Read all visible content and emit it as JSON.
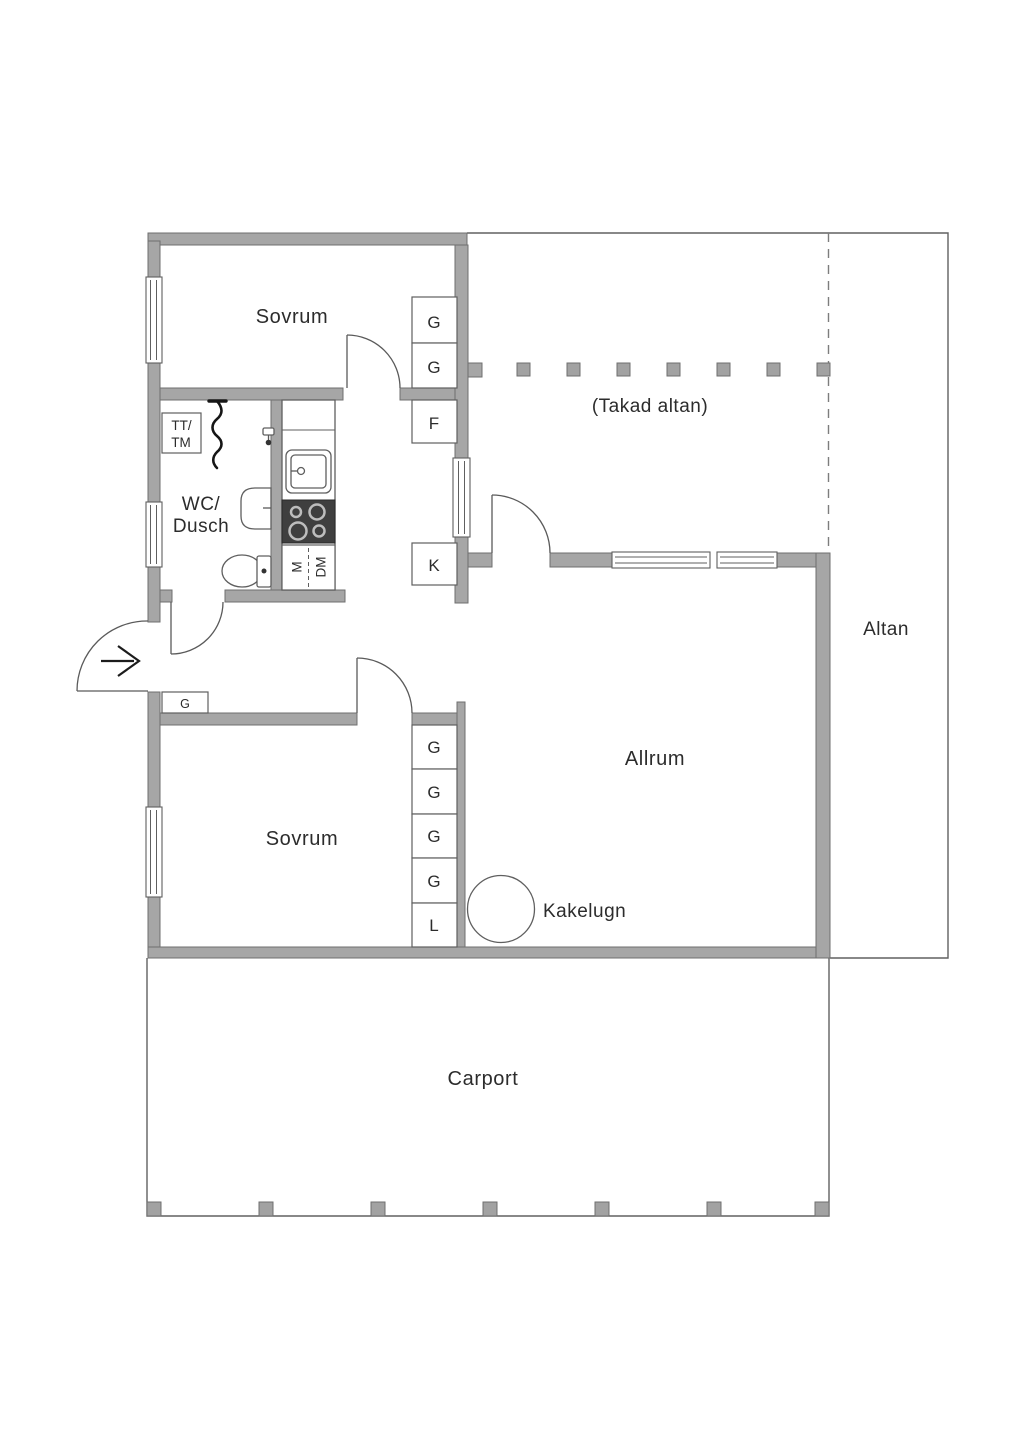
{
  "rooms": {
    "bedroom_top": "Sovrum",
    "covered_terrace": "(Takad altan)",
    "wc_shower": {
      "line1": "WC/",
      "line2": "Dusch"
    },
    "terrace": "Altan",
    "living_room": "Allrum",
    "bedroom_bottom": "Sovrum",
    "carport": "Carport"
  },
  "fixtures": {
    "tiled_stove_label": "Kakelugn",
    "laundry": {
      "line1": "TT/",
      "line2": "TM"
    },
    "microwave": "M",
    "dishwasher": "DM",
    "freezer": "F",
    "fridge": "K"
  },
  "closets": {
    "bedroom_top": [
      "G",
      "G"
    ],
    "hall": "G",
    "bedroom_bottom": [
      "G",
      "G",
      "G",
      "G",
      "L"
    ]
  },
  "colors": {
    "wall_fill": "#a6a6a6",
    "wall_stroke": "#6f6f6f",
    "line": "#5a5a5a",
    "text": "#2c2c2c",
    "stove_fill": "#3f3f3f",
    "background": "#ffffff"
  }
}
